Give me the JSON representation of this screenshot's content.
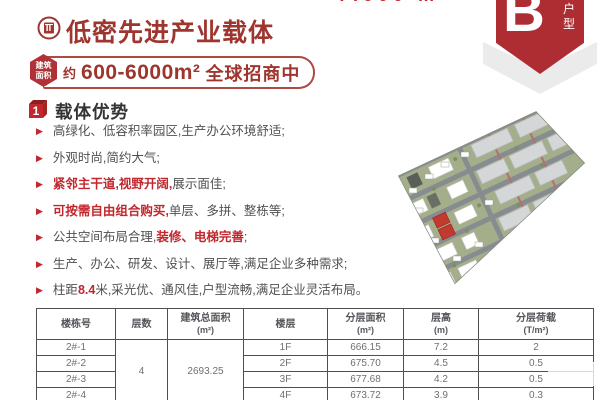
{
  "colors": {
    "brand_red": "#9e352e",
    "accent_red": "#c1272d",
    "badge_red": "#ad2d33",
    "chevron_gray": "#ebebeb",
    "body_text": "#4f5052",
    "table_border": "#4f4f4f",
    "table_text": "#6e7072",
    "map_highlight": "#c13a30"
  },
  "header": {
    "cropped_top_text": "7.000 m",
    "title": "低密先进产业载体",
    "badge_letter": "B",
    "badge_label_1": "户",
    "badge_label_2": "型"
  },
  "area": {
    "tag_line1": "建筑",
    "tag_line2": "面积",
    "prefix": "约",
    "range": "600-6000m²",
    "suffix": "全球招商中"
  },
  "ui": {
    "bullet_icon": "▶"
  },
  "section": {
    "number": "1",
    "title": "载体优势",
    "bullets": [
      {
        "segs": [
          {
            "t": "高绿化、低容积率园区,生产办公环境舒适;"
          }
        ]
      },
      {
        "segs": [
          {
            "t": "外观时尚,简约大气;"
          }
        ]
      },
      {
        "segs": [
          {
            "t": "紧邻主干道,视野开阔,",
            "red": true
          },
          {
            "t": "展示面佳;"
          }
        ]
      },
      {
        "segs": [
          {
            "t": "可按需自由组合购买,",
            "red": true
          },
          {
            "t": "单层、多拼、整栋等;"
          }
        ]
      },
      {
        "segs": [
          {
            "t": "公共空间布局合理,"
          },
          {
            "t": "装修、电梯完善",
            "red": true
          },
          {
            "t": ";"
          }
        ]
      },
      {
        "segs": [
          {
            "t": "生产、办公、研发、设计、展厅等,满足企业多种需求;"
          }
        ]
      },
      {
        "segs": [
          {
            "t": "柱距"
          },
          {
            "t": "8.4",
            "red": true
          },
          {
            "t": "米,采光优、通风佳,户型流畅,满足企业灵活布局。"
          }
        ]
      }
    ]
  },
  "table": {
    "headers": [
      {
        "l1": "楼栋号"
      },
      {
        "l1": "层数"
      },
      {
        "l1": "建筑总面积",
        "l2": "(m²)"
      },
      {
        "l1": "楼层"
      },
      {
        "l1": "分层面积",
        "l2": "(m²)"
      },
      {
        "l1": "层高",
        "l2": "(m)"
      },
      {
        "l1": "分层荷载",
        "l2": "(T/m²)"
      }
    ],
    "merged": {
      "floors_count": "4",
      "total_area": "2693.25"
    },
    "rows": [
      {
        "bld": "2#-1",
        "floor": "1F",
        "area": "666.15",
        "height": "7.2",
        "load": "2"
      },
      {
        "bld": "2#-2",
        "floor": "2F",
        "area": "675.70",
        "height": "4.5",
        "load": "0.5"
      },
      {
        "bld": "2#-3",
        "floor": "3F",
        "area": "677.68",
        "height": "4.2",
        "load": "0.5"
      },
      {
        "bld": "2#-4",
        "floor": "4F",
        "area": "673.72",
        "height": "3.9",
        "load": "0.3"
      }
    ]
  }
}
